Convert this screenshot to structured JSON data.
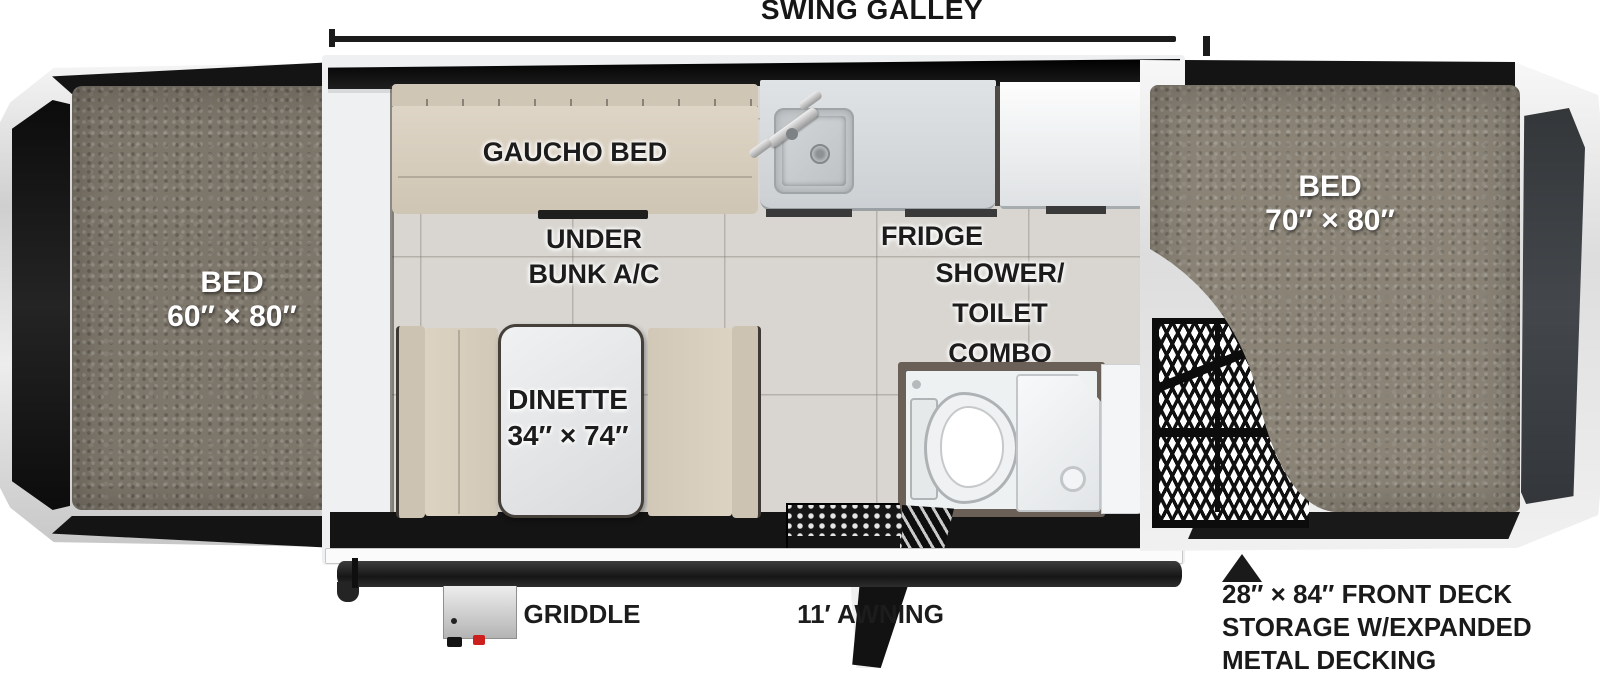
{
  "title": "SWING GALLEY",
  "labels": {
    "left_bed": {
      "lines": [
        "BED",
        "60″ × 80″"
      ]
    },
    "right_bed": {
      "lines": [
        "BED",
        "70″ × 80″"
      ]
    },
    "gaucho_bed": "GAUCHO BED",
    "under_bunk_ac": {
      "lines": [
        "UNDER",
        "BUNK A/C"
      ]
    },
    "dinette": {
      "lines": [
        "DINETTE",
        "34″ × 74″"
      ]
    },
    "fridge": "FRIDGE",
    "shower_toilet_combo": {
      "lines": [
        "SHOWER/",
        "TOILET",
        "COMBO"
      ]
    },
    "griddle": "GRIDDLE",
    "awning": "11′ AWNING",
    "front_deck": {
      "lines": [
        "28″ × 84″ FRONT DECK",
        "STORAGE W/EXPANDED",
        "METAL DECKING"
      ]
    }
  },
  "colors": {
    "label_ink": "#1c1c1c",
    "bed_label_text": "#ffffff",
    "left_mattress": "#7d766a",
    "right_mattress": "#8a8376",
    "floor_tile": "#d9d6d1",
    "cushion": "#d5cbba",
    "counter": "#d4d7d9",
    "shower_frame": "#6a6057",
    "body_black": "#141414",
    "griddle_knob": "#ce1f1f"
  }
}
